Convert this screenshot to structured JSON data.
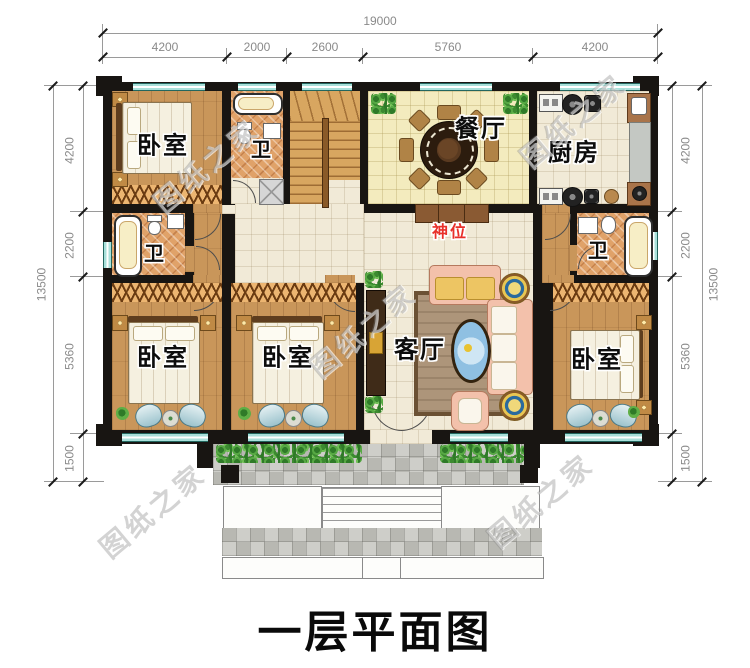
{
  "title": "一层平面图",
  "watermark": "图纸之家",
  "colors": {
    "wall": "#181512",
    "window_teal": "#9fdcd8",
    "wood_floor": "#c9965a",
    "tile_cream": "#f1ead7",
    "shrine_red": "#e8302a"
  },
  "dimensions": {
    "top": {
      "total": "19000",
      "segments": [
        "4200",
        "2000",
        "2600",
        "5760",
        "4200"
      ]
    },
    "left": {
      "total": "13500",
      "segments": [
        "4200",
        "2200",
        "5360",
        "1500"
      ]
    },
    "right": {
      "total": "13500",
      "segments": [
        "4200",
        "2200",
        "5360",
        "1500"
      ]
    }
  },
  "rooms": {
    "bedroom_top_left": "卧室",
    "bath_top": "卫",
    "dining": "餐厅",
    "kitchen": "厨房",
    "bath_left": "卫",
    "bath_right": "卫",
    "bedroom_bottom_left": "卧室",
    "bedroom_bottom_middle": "卧室",
    "living": "客厅",
    "bedroom_bottom_right": "卧室",
    "shrine": "神位"
  }
}
